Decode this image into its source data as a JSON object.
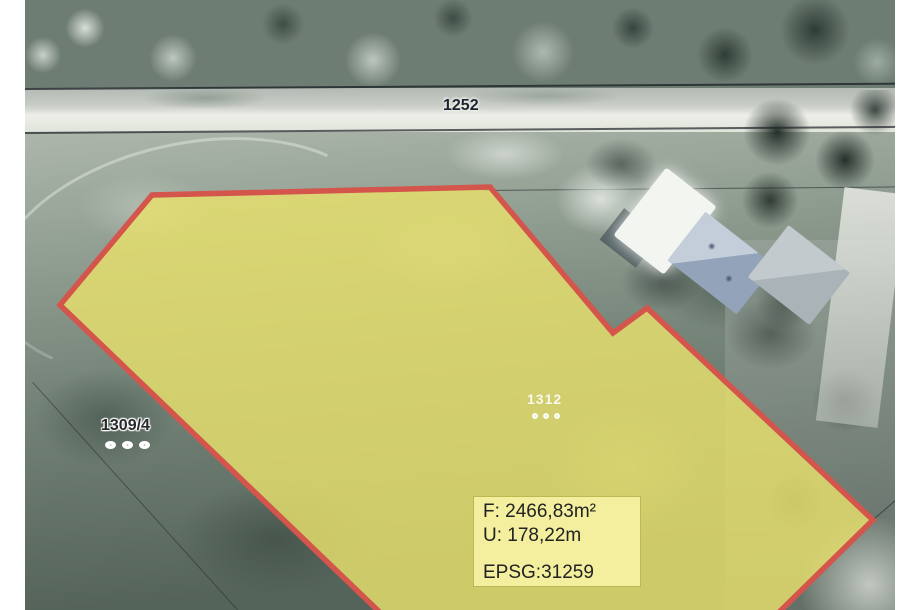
{
  "map": {
    "parcel_labels": {
      "road": "1252",
      "neighbor": "1309/4",
      "selected": "1312"
    },
    "info_box": {
      "area": "F: 2466,83m²",
      "perimeter": "U: 178,22m",
      "crs": "EPSG:31259"
    },
    "colors": {
      "selected_parcel_fill": "#e8e06c",
      "selected_parcel_border": "#d4554b",
      "info_box_background": "#f3ef9e"
    }
  }
}
